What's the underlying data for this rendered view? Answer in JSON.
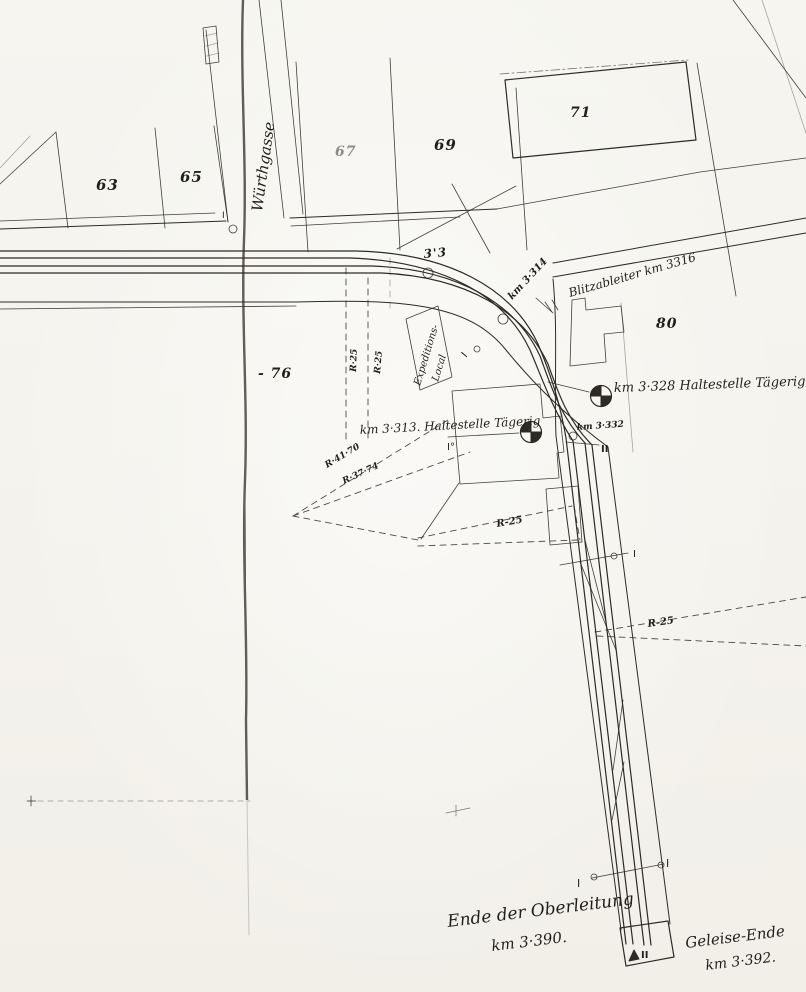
{
  "palette": {
    "paper": "#f6f5f0",
    "ink": "#2e2b26",
    "crease": "#3a372f"
  },
  "labels": {
    "street": "Würthgasse",
    "parcels": {
      "p63": "63",
      "p65": "65",
      "p67": "67",
      "p69": "69",
      "p71": "71",
      "p76": "- 76",
      "p80": "80"
    },
    "track": {
      "gauge": "3'3",
      "km3314": "km 3·314",
      "blitzableiter": "Blitzableiter km 3316",
      "halt3328": "km 3·328 Haltestelle Tägerig",
      "halt3313": "km 3·313. Haltestelle Tägerig",
      "km3332": "km 3·332",
      "expeditions1": "Expeditions-",
      "expeditions2": "Local",
      "r25v1": "R·25",
      "r25v2": "R·25",
      "r4170": "R·41·70",
      "r3774": "R·37·74",
      "r25a": "R-25",
      "r25b": "R-25",
      "ende1": "Ende der Oberleitung",
      "ende2": "km 3·390.",
      "geleise1": "Geleise-Ende",
      "geleise2": "km 3·392."
    },
    "markers": {
      "i_top": "I",
      "io_curve": "I",
      "i_sec": "I°",
      "ii_a": "II",
      "i_mid": "I",
      "i_left": "I",
      "i_right": "I",
      "ii_end": "II"
    }
  }
}
